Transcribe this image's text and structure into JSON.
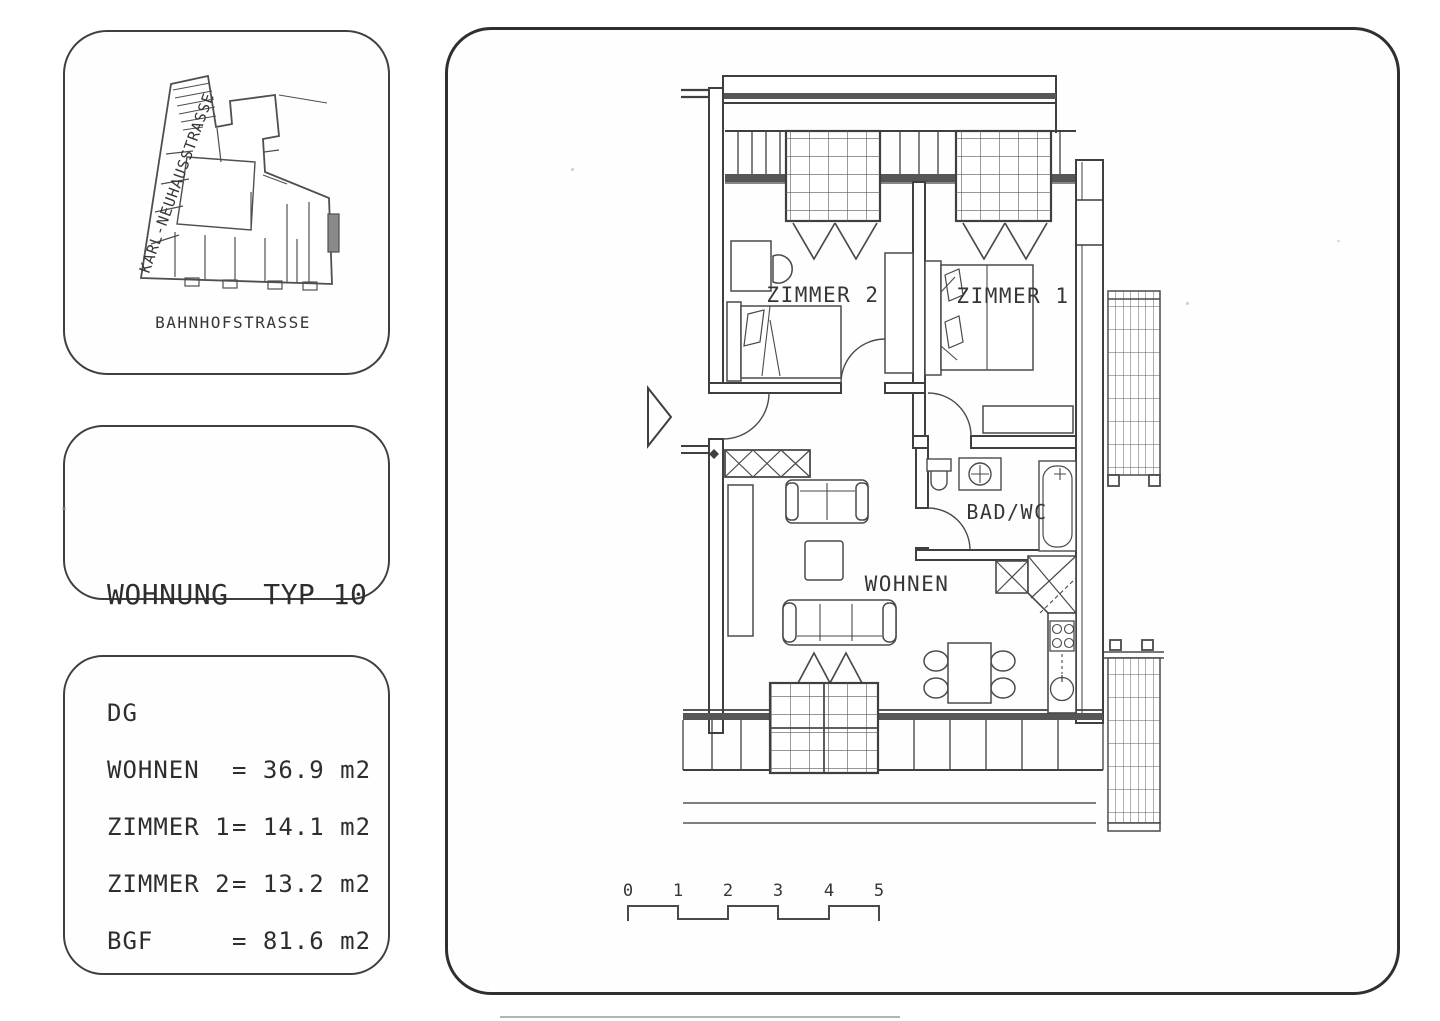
{
  "palette": {
    "line": "#404040",
    "line_dark": "#2f2f2f",
    "sill_fill": "#565656",
    "paper": "#ffffff"
  },
  "site_card": {
    "street_diagonal": "KARL-NEUHAUSSTRASSE",
    "street_bottom": "BAHNHOFSTRASSE"
  },
  "title_card": {
    "line1": "WOHNUNG  TYP 10",
    "line2": "3 ZIMMER"
  },
  "area_card": {
    "floor_label": "DG",
    "rows": [
      {
        "label": "WOHNEN",
        "value": "= 36.9 m2"
      },
      {
        "label": "ZIMMER 1",
        "value": "= 14.1 m2"
      },
      {
        "label": "ZIMMER 2",
        "value": "= 13.2 m2"
      },
      {
        "label": "BGF",
        "value": "= 81.6 m2"
      }
    ]
  },
  "plan": {
    "room_labels": {
      "zimmer2": "ZIMMER 2",
      "zimmer1": "ZIMMER 1",
      "bad_wc": "BAD/WC",
      "wohnen": "WOHNEN"
    },
    "scale_ticks": [
      "0",
      "1",
      "2",
      "3",
      "4",
      "5"
    ]
  }
}
